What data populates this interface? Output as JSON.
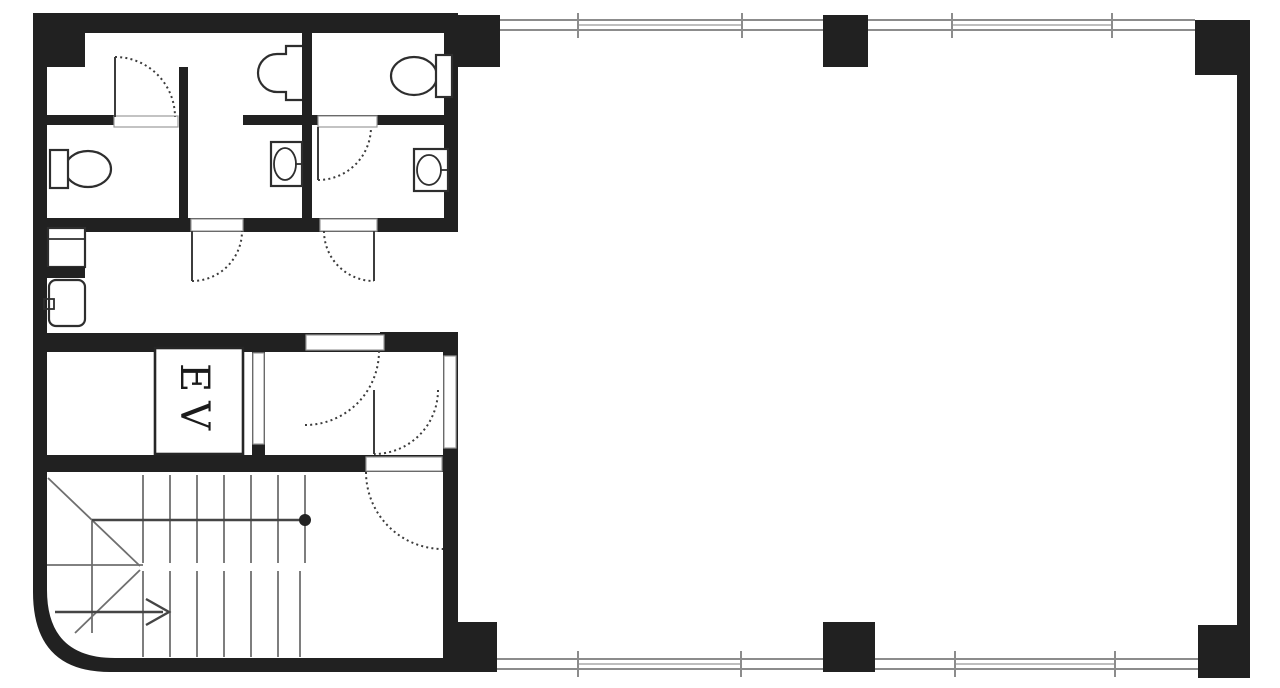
{
  "floorplan": {
    "elevator_label": "EV",
    "colors": {
      "wall": "#212121",
      "window_line": "#8c8c8c",
      "door_arc": "#3c3c3c",
      "background": "#ffffff"
    },
    "fixtures": [
      "elevator",
      "staircase",
      "toilet",
      "toilet",
      "urinal",
      "hand-wash-sink",
      "hand-wash-sink",
      "utility-sink",
      "counter"
    ]
  }
}
